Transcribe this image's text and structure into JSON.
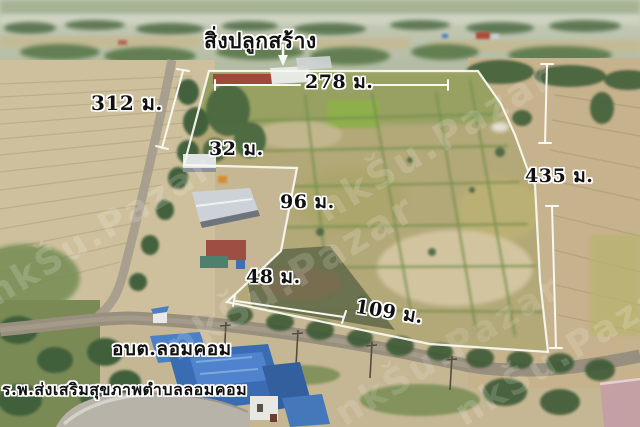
{
  "callout": {
    "building_label": "สิ่งปลูกสร้าง"
  },
  "measurements": {
    "top": "278 ม.",
    "left": "312 ม.",
    "notch_top": "32 ม.",
    "notch_side": "96 ม.",
    "notch_diagonal": "48 ม.",
    "bottom": "109 ม.",
    "right": "435 ม."
  },
  "landmarks": {
    "sao": "อบต.ลอมคอม",
    "hospital": "ร.พ.ส่งเสริมสุขภาพตำบลลอมคอม"
  },
  "watermark": {
    "text": "nkŠu.Pazar"
  },
  "colors": {
    "annotation_line": "#f7f8ef",
    "label_text": "#101010",
    "label_outline": "#ffffff",
    "blue_roof": "#3a6cb4",
    "red_roof": "#9e4a3a",
    "watermark": "rgba(255,255,255,0.16)"
  }
}
